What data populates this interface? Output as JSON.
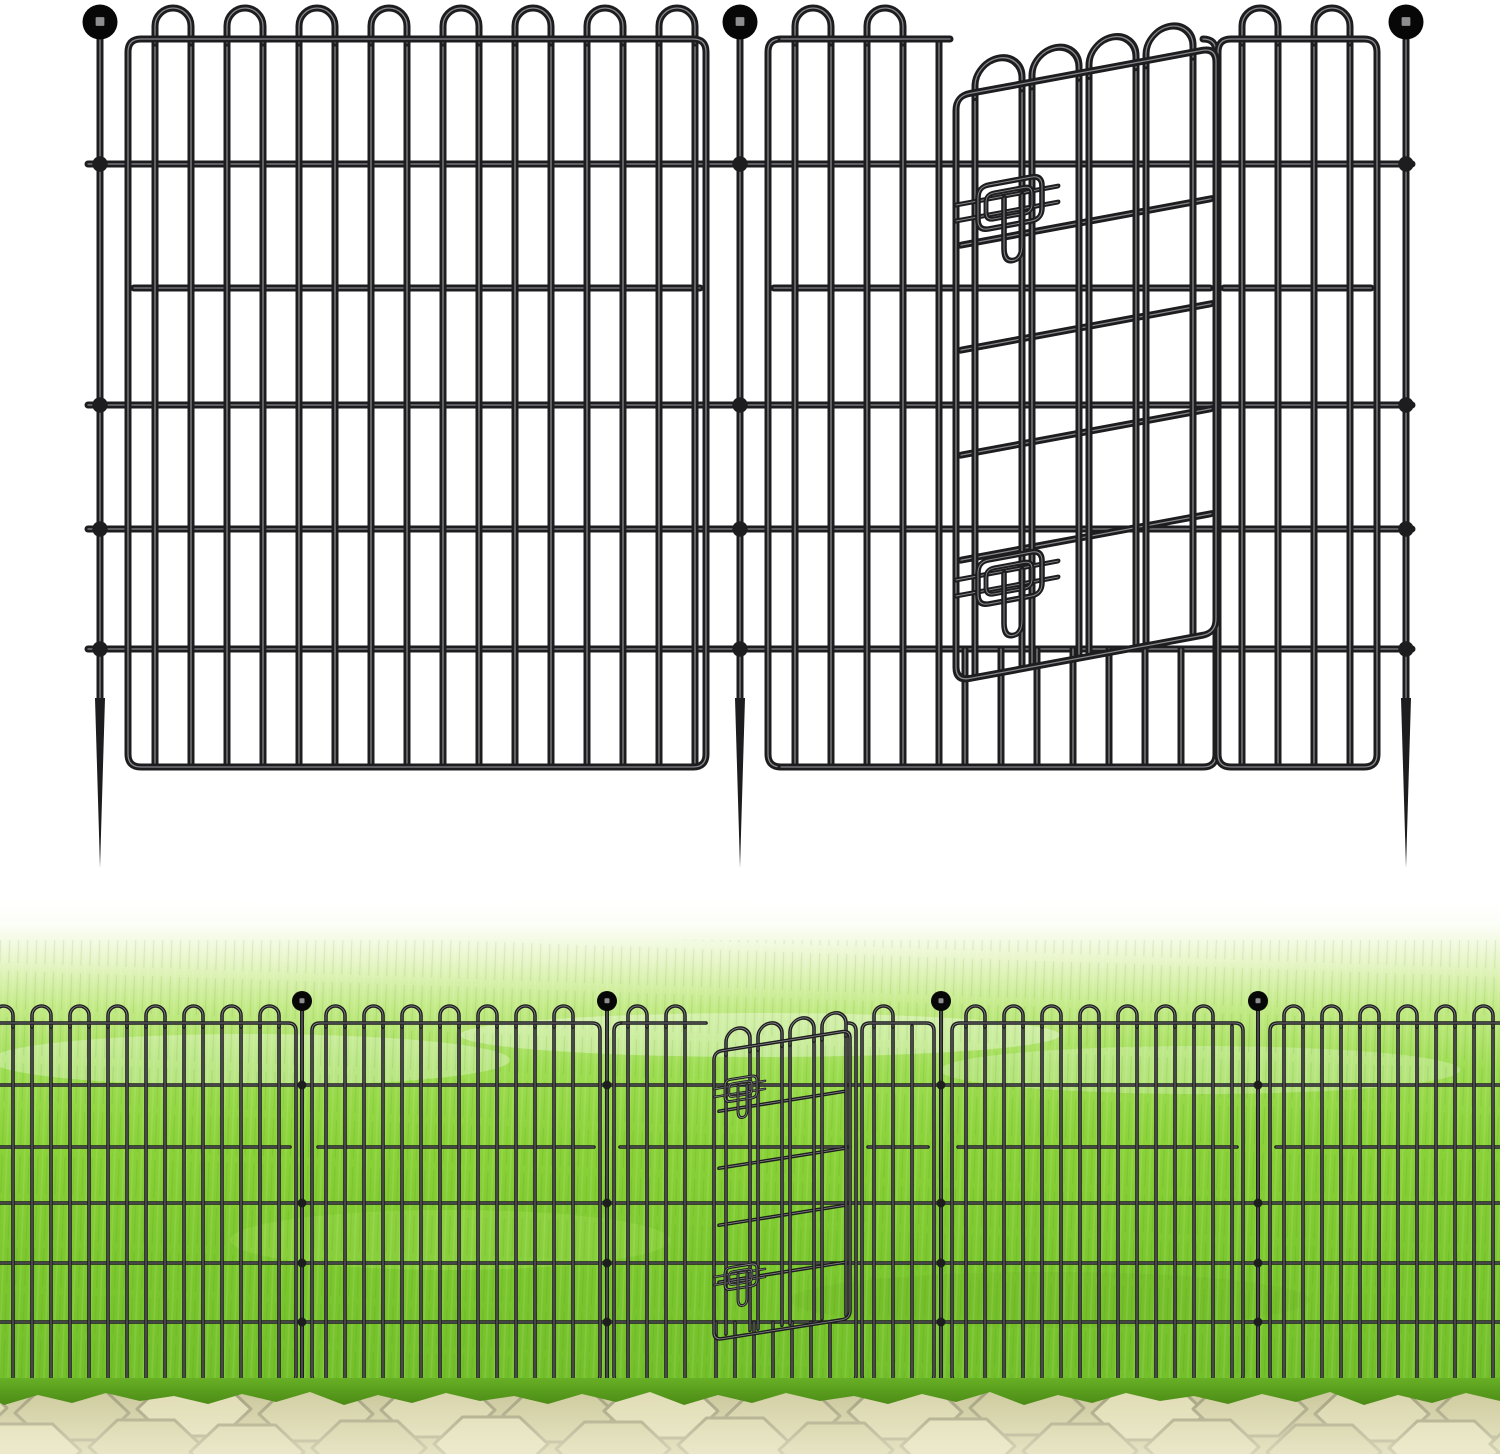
{
  "image": {
    "kind": "e-commerce product illustration",
    "subject": "Black metal no-dig garden fence panels with ground-spike posts, ball finials and a latching swing gate, shown as a line diagram (top) and installed on a lawn beside a paver walkway (bottom)",
    "canvas": {
      "width": 1500,
      "height": 1454
    }
  },
  "palette": {
    "background": "#ffffff",
    "wire": "#1d1d1f",
    "wire_core": "#96969a",
    "ball": "#070708",
    "ball_glint": "#8e8e91",
    "grass_stops": [
      [
        0,
        "#ffffff"
      ],
      [
        0.05,
        "#fcfef8"
      ],
      [
        0.12,
        "#e9f6cb"
      ],
      [
        0.22,
        "#c2ea85"
      ],
      [
        0.34,
        "#9edd52"
      ],
      [
        0.5,
        "#8ad238"
      ],
      [
        0.72,
        "#7cc82e"
      ],
      [
        1,
        "#73bf2a"
      ]
    ],
    "grass_patches": [
      [
        250,
        1060,
        260,
        26,
        "#ffffff",
        0.3
      ],
      [
        760,
        1035,
        300,
        22,
        "#ffffff",
        0.35
      ],
      [
        1200,
        1070,
        260,
        24,
        "#ffffff",
        0.25
      ],
      [
        450,
        1240,
        220,
        30,
        "#a4e05a",
        0.3
      ],
      [
        1050,
        1300,
        260,
        28,
        "#6db123",
        0.25
      ]
    ],
    "fringe_top": "#68b026",
    "fringe_bottom": "#4b8a15",
    "path_base": "#cbc79c",
    "paver_fills": [
      "#d8d5ac",
      "#cecb9e",
      "#dfdcb5",
      "#d2cfa4"
    ],
    "paver_joint": "#a09e7c",
    "path_glow": "#f4f2d8"
  },
  "diagram_fence": {
    "stroke": 7,
    "step": 36,
    "loop_rise": 31,
    "rail_y": 288,
    "short_from": 649,
    "frame": {
      "top": 39,
      "bottom": 767,
      "r": 13
    },
    "rods": {
      "ys": [
        164,
        405,
        529,
        649
      ],
      "x1": 88,
      "x2": 1412
    },
    "posts": {
      "xs": [
        100,
        740,
        1406
      ],
      "ball_cy": 22,
      "ball_r": 17.5,
      "rod_top": 36,
      "rod_bottom": 706,
      "rod_w": 7,
      "spike": [
        698,
        868
      ]
    },
    "panels": [
      {
        "name": "panel-left",
        "x1": 128,
        "x2": 706,
        "bars": [
          [
            155,
            695
          ]
        ]
      },
      {
        "name": "panel-gate-section",
        "x1": 768,
        "x2": 1216,
        "top_segments": [
          [
            781,
            950
          ]
        ],
        "bars": [
          [
            795,
            940
          ]
        ],
        "short": [
          [
            965,
            1205
          ]
        ]
      },
      {
        "name": "panel-right",
        "x1": 1218,
        "x2": 1377,
        "bars": [
          [
            1242,
            1350
          ]
        ]
      }
    ],
    "gate": {
      "x": 956,
      "y": 96,
      "skew": -10.5,
      "w": 260,
      "h": 585,
      "r": 14,
      "rise": 30,
      "bars": [
        19,
        66,
        76,
        123,
        133,
        180,
        190,
        237
      ],
      "loop_pairs": [
        [
          19,
          66
        ],
        [
          76,
          123
        ],
        [
          133,
          180
        ],
        [
          190,
          237
        ]
      ],
      "rails": [
        150,
        255,
        360,
        465
      ],
      "latch": {
        "s": 1,
        "ax": 22,
        "lys": [
          95,
          470
        ]
      }
    }
  },
  "scene": {
    "grass": {
      "y1": 900,
      "y2": 1392
    },
    "path": {
      "y1": 1390,
      "y2": 1454
    },
    "pavers": {
      "row_cys": [
        1412,
        1448
      ],
      "step": 118,
      "hex_w": 114,
      "hex_h": 54,
      "row_offset": 60,
      "joint_w": 3
    },
    "fence": {
      "stroke": 3.6,
      "step": 19,
      "loop_rise": 17,
      "rail_y": 1147,
      "short_from": 1322,
      "frame": {
        "top": 1023,
        "bottom": 1383,
        "r": 8
      },
      "rods": {
        "ys": [
          1085,
          1203,
          1263,
          1322
        ],
        "x1": -5,
        "x2": 1505
      },
      "posts": {
        "xs": [
          302,
          607,
          941,
          1258
        ],
        "ball_cy": 1001,
        "ball_r": 10,
        "rod_top": 1008,
        "rod_bottom": 1384,
        "rod_w": 4
      },
      "panels": [
        {
          "name": "panel-1",
          "x1": -24,
          "x2": 296,
          "bars": [
            [
              -6,
              282
            ]
          ]
        },
        {
          "name": "panel-2",
          "x1": 312,
          "x2": 600,
          "bars": [
            [
              326,
              588
            ]
          ]
        },
        {
          "name": "panel-gate-section",
          "x1": 614,
          "x2": 856,
          "top_segments": [
            [
              622,
              706
            ]
          ],
          "bars": [
            [
              628,
              700
            ]
          ],
          "short": [
            [
              716,
              848
            ]
          ]
        },
        {
          "name": "panel-hinge-strip",
          "x1": 862,
          "x2": 934,
          "bars": [
            [
              874,
              926
            ]
          ]
        },
        {
          "name": "panel-3",
          "x1": 952,
          "x2": 1243,
          "bars": [
            [
              966,
              1232
            ]
          ]
        },
        {
          "name": "panel-4",
          "x1": 1270,
          "x2": 1530,
          "bars": [
            [
              1284,
              1500
            ]
          ]
        }
      ],
      "gate": {
        "x": 714,
        "y": 1052,
        "skew": -9,
        "w": 136,
        "h": 288,
        "r": 8,
        "rise": 20,
        "bars": [
          12,
          36,
          44,
          68,
          76,
          100,
          108,
          132
        ],
        "loop_pairs": [
          [
            12,
            36
          ],
          [
            44,
            68
          ],
          [
            76,
            100
          ],
          [
            108,
            132
          ]
        ],
        "rails": [
          60,
          117,
          174,
          231
        ],
        "latch": {
          "s": 0.5,
          "ax": 11,
          "lys": [
            30,
            218
          ]
        }
      }
    }
  }
}
